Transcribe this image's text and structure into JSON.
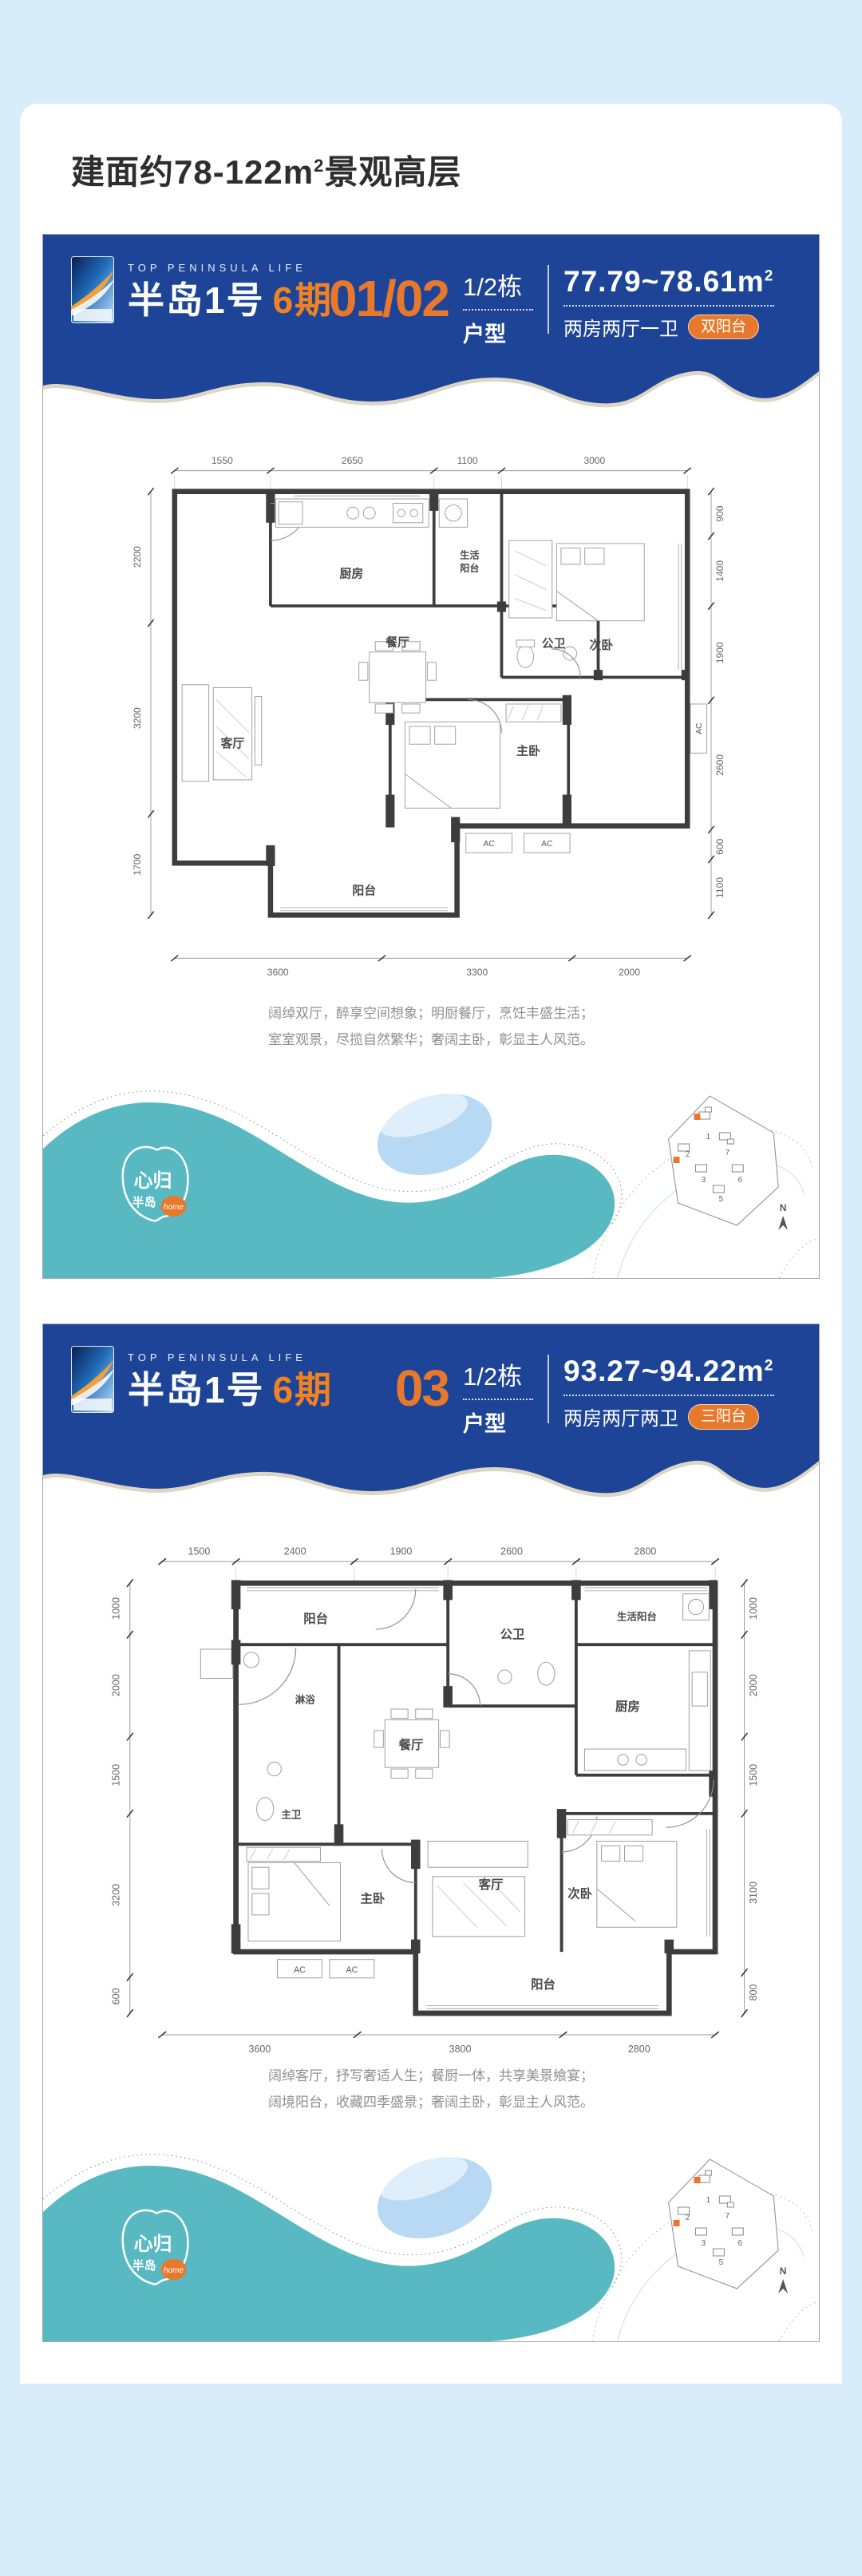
{
  "badge": {
    "text": "【6期在售产品】"
  },
  "title": {
    "prefix": "建面约78-122m",
    "sup": "2",
    "suffix": "景观高层"
  },
  "brand": {
    "tagline": "TOP PENINSULA LIFE",
    "name": "半岛1号",
    "phase": "6期"
  },
  "colors": {
    "header_blue": "#1d4496",
    "accent_orange": "#e8792c",
    "teal": "#58b9c2",
    "badge_blue": "#79c5f4",
    "tab_yellow": "#ffe60a"
  },
  "footer": {
    "stamp_line1": "心归",
    "stamp_line2": "半岛",
    "stamp_badge": "home",
    "compass": "N",
    "buildings": [
      "1",
      "2",
      "7",
      "3",
      "6",
      "5"
    ]
  },
  "plans": [
    {
      "unit": "01/02",
      "building": "1/2栋",
      "type_label": "户型",
      "area": "77.79~78.61m",
      "area_sup": "2",
      "layout": "两房两厅一卫",
      "balcony_tag": "双阳台",
      "desc1": "阔绰双厅，醉享空间想象；明厨餐厅，烹饪丰盛生活；",
      "desc2": "室室观景，尽揽自然繁华；奢阔主卧，彰显主人风范。",
      "rooms": {
        "kitchen": "厨房",
        "service_balcony_1": "生活",
        "service_balcony_2": "阳台",
        "public_bath": "公卫",
        "dining": "餐厅",
        "second_bedroom": "次卧",
        "living": "客厅",
        "master_bedroom": "主卧",
        "balcony": "阳台",
        "ac": "AC"
      },
      "dims_top": [
        "1550",
        "2650",
        "1100",
        "3000"
      ],
      "dims_left": [
        "2200",
        "3200",
        "1700"
      ],
      "dims_right": [
        "900",
        "1400",
        "1900",
        "2600",
        "600",
        "1100"
      ],
      "dims_bottom": [
        "3600",
        "3300",
        "2000"
      ]
    },
    {
      "unit": "03",
      "building": "1/2栋",
      "type_label": "户型",
      "area": "93.27~94.22m",
      "area_sup": "2",
      "layout": "两房两厅两卫",
      "balcony_tag": "三阳台",
      "desc1": "阔绰客厅，抒写奢适人生；餐厨一体，共享美景飨宴；",
      "desc2": "阔境阳台，收藏四季盛景；奢阔主卧，彰显主人风范。",
      "rooms": {
        "balcony_top": "阳台",
        "public_bath": "公卫",
        "service_balcony": "生活阳台",
        "shower": "淋浴",
        "dining": "餐厅",
        "kitchen": "厨房",
        "master_bath": "主卫",
        "master_bedroom": "主卧",
        "living": "客厅",
        "second_bedroom": "次卧",
        "balcony_bottom": "阳台",
        "ac": "AC"
      },
      "dims_top": [
        "1500",
        "2400",
        "1900",
        "2600",
        "2800"
      ],
      "dims_left": [
        "1000",
        "2000",
        "1500",
        "3200",
        "600"
      ],
      "dims_right": [
        "1000",
        "2000",
        "1500",
        "3100",
        "800"
      ],
      "dims_bottom": [
        "3600",
        "3800",
        "2800"
      ]
    }
  ]
}
